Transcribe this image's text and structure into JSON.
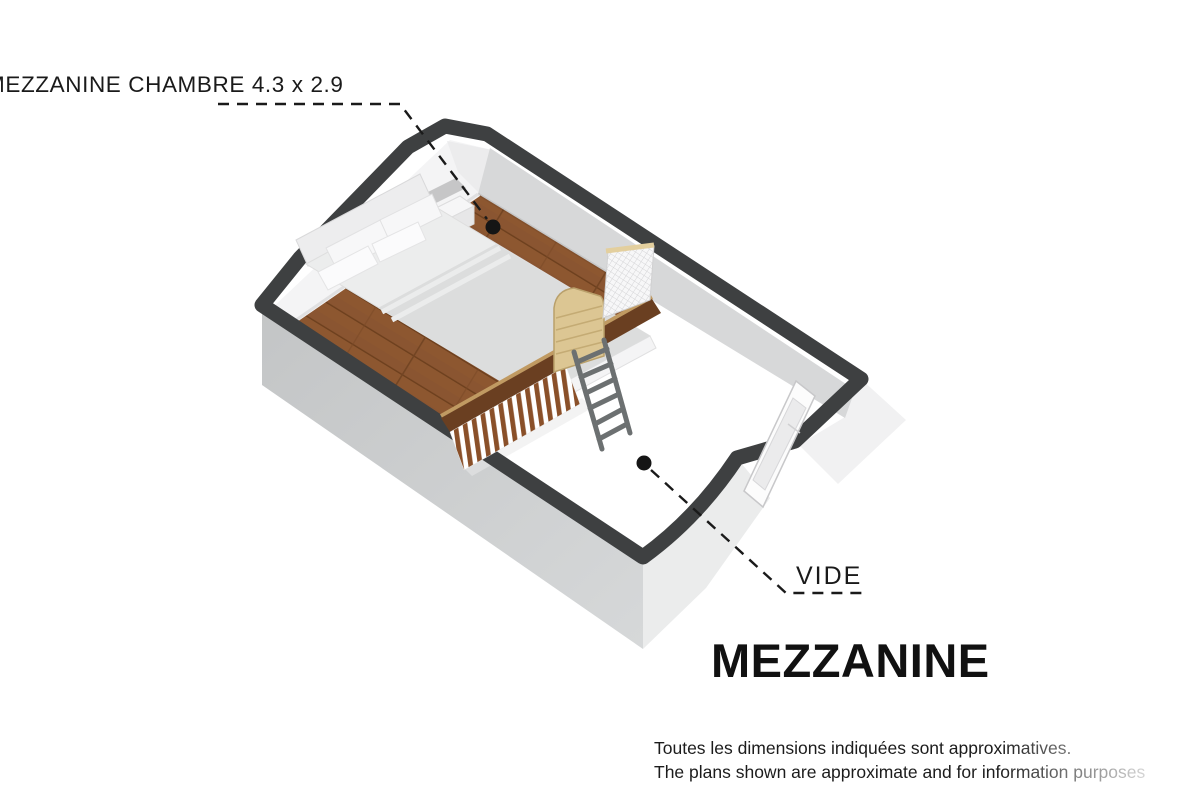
{
  "labels": {
    "room": "MEZZANINE CHAMBRE 4.3 x 2.9",
    "void": "VIDE",
    "title": "MEZZANINE"
  },
  "disclaimer": {
    "line1": "Toutes les dimensions indiquées sont approximatives.",
    "line2": "The plans shown are approximate and for information purposes"
  },
  "colors": {
    "background": "#ffffff",
    "wall_cap": "#3e4041",
    "wall_exterior": "#c6c8c9",
    "wall_exterior_light": "#ececed",
    "wall_interior_light": "#f4f4f5",
    "wall_interior_shaded": "#d7d8d9",
    "wood_floor": "#8a5531",
    "void_floor": "#ffffff",
    "railing_slat_wood": "#8a5029",
    "railing_fascia": "#6a3f21",
    "gate_wood": "#dcc693",
    "mesh_panel": "#f7f7f8",
    "ladder": "#6c7071",
    "bed_linen": "#ececed",
    "duvet": "#dcdddd",
    "leader_line": "#1a1a1a",
    "label_text": "#1a1a1a"
  }
}
